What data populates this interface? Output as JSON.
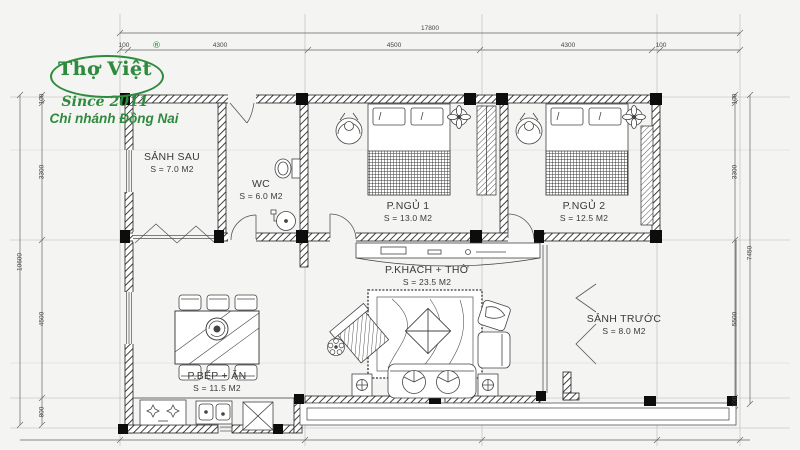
{
  "logo": {
    "brand": "Thợ Việt",
    "registered": "®",
    "tagline": "Since 2011",
    "branch": "Chi nhánh Đồng Nai"
  },
  "dimensions": {
    "top": {
      "total": "17800",
      "segments": [
        "100",
        "4300",
        "4500",
        "4300",
        "100"
      ]
    },
    "left": {
      "total": "10600",
      "segments": [
        "100",
        "3300",
        "4500",
        "800"
      ]
    },
    "right": {
      "total": "7450",
      "segments": [
        "100",
        "3300",
        "5500",
        "100"
      ]
    }
  },
  "rooms": [
    {
      "name": "SẢNH SAU",
      "area": "S = 7.0 M2"
    },
    {
      "name": "WC",
      "area": "S = 6.0 M2"
    },
    {
      "name": "P.NGỦ 1",
      "area": "S = 13.0 M2"
    },
    {
      "name": "P.NGỦ 2",
      "area": "S = 12.5 M2"
    },
    {
      "name": "P.KHÁCH + THỜ",
      "area": "S = 23.5 M2"
    },
    {
      "name": "SẢNH TRƯỚC",
      "area": "S = 8.0 M2"
    },
    {
      "name": "P.BẾP + ĂN",
      "area": "S = 11.5 M2"
    }
  ],
  "colors": {
    "brand_green": "#2e8b3d",
    "line_dark": "#2b2b2b",
    "line_light": "#b5b5b5",
    "paper": "#f4f4f2"
  }
}
